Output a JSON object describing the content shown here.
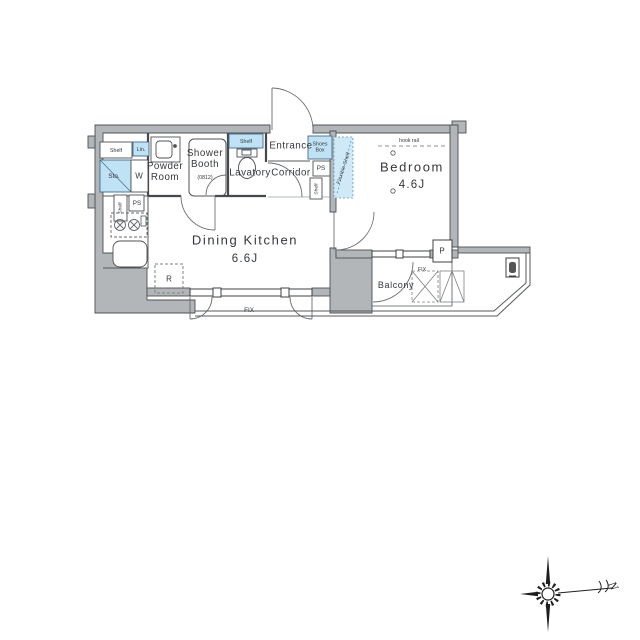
{
  "colors": {
    "wall_gray": "#b2b6b9",
    "accent_blue": "#bfe3f4",
    "line": "#4d5154"
  },
  "rooms": {
    "dining_kitchen": {
      "label": "Dining Kitchen",
      "size": "6.6J"
    },
    "bedroom": {
      "label": "Bedroom",
      "size": "4.6J"
    },
    "entrance": {
      "label": "Entrance"
    },
    "corridor": {
      "label": "Corridor"
    },
    "lavatory": {
      "label": "Lavatory"
    },
    "powder_room": {
      "line1": "Powder",
      "line2": "Room"
    },
    "shower_booth": {
      "line1": "Shower",
      "line2": "Booth",
      "size": "(0812)"
    },
    "balcony": {
      "label": "Balcony"
    }
  },
  "fixtures": {
    "shelf_top": "Shelf",
    "linen": "Lin.",
    "storage": "Sto.",
    "washer": "W",
    "shelf_kitchen": "Shelf",
    "ps_kitchen": "PS",
    "shelf_lavatory": "Shelf",
    "shoes_box_line1": "Shoes",
    "shoes_box_line2": "Box",
    "ps_corridor": "PS",
    "shelf_corridor": "Shelf",
    "flexible_shelf": "Flexible Shelf",
    "hook_rail": "hook rail",
    "refrigerator": "R",
    "pipe_space": "P",
    "fix_window": "FIX",
    "fix_balcony": "FIX"
  },
  "compass": {
    "north_label": "N"
  }
}
